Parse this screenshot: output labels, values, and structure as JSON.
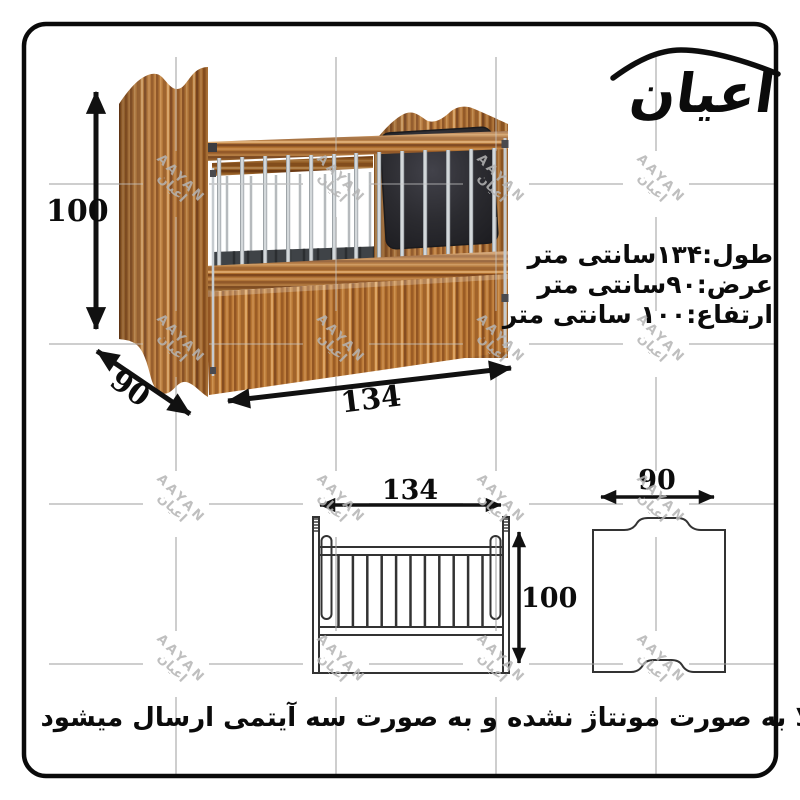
{
  "brand": {
    "name": "اعیان"
  },
  "specs": {
    "length_line": "طول:۱۳۴سانتی متر",
    "width_line": "عرض:۹۰سانتی متر",
    "height_line": "ارتفاع:۱۰۰ سانتی متر"
  },
  "dimensions_3d": {
    "height": "100",
    "depth": "90",
    "length": "134"
  },
  "front_view": {
    "width": "134",
    "height": "100"
  },
  "side_view": {
    "width": "90"
  },
  "caption": "کالا به صورت مونتاژ نشده و به صورت سه آیتمی ارسال میشود",
  "watermark": {
    "latin": "AAYAN",
    "persian": "اعیان"
  },
  "colors": {
    "wood_mid": "#b1702f",
    "pad_dark": "#27272b",
    "chrome": "#c9ced2",
    "outline": "#333333",
    "grid": "#d2d2d2",
    "arrow": "#111111",
    "border": "#0a0a0a"
  }
}
